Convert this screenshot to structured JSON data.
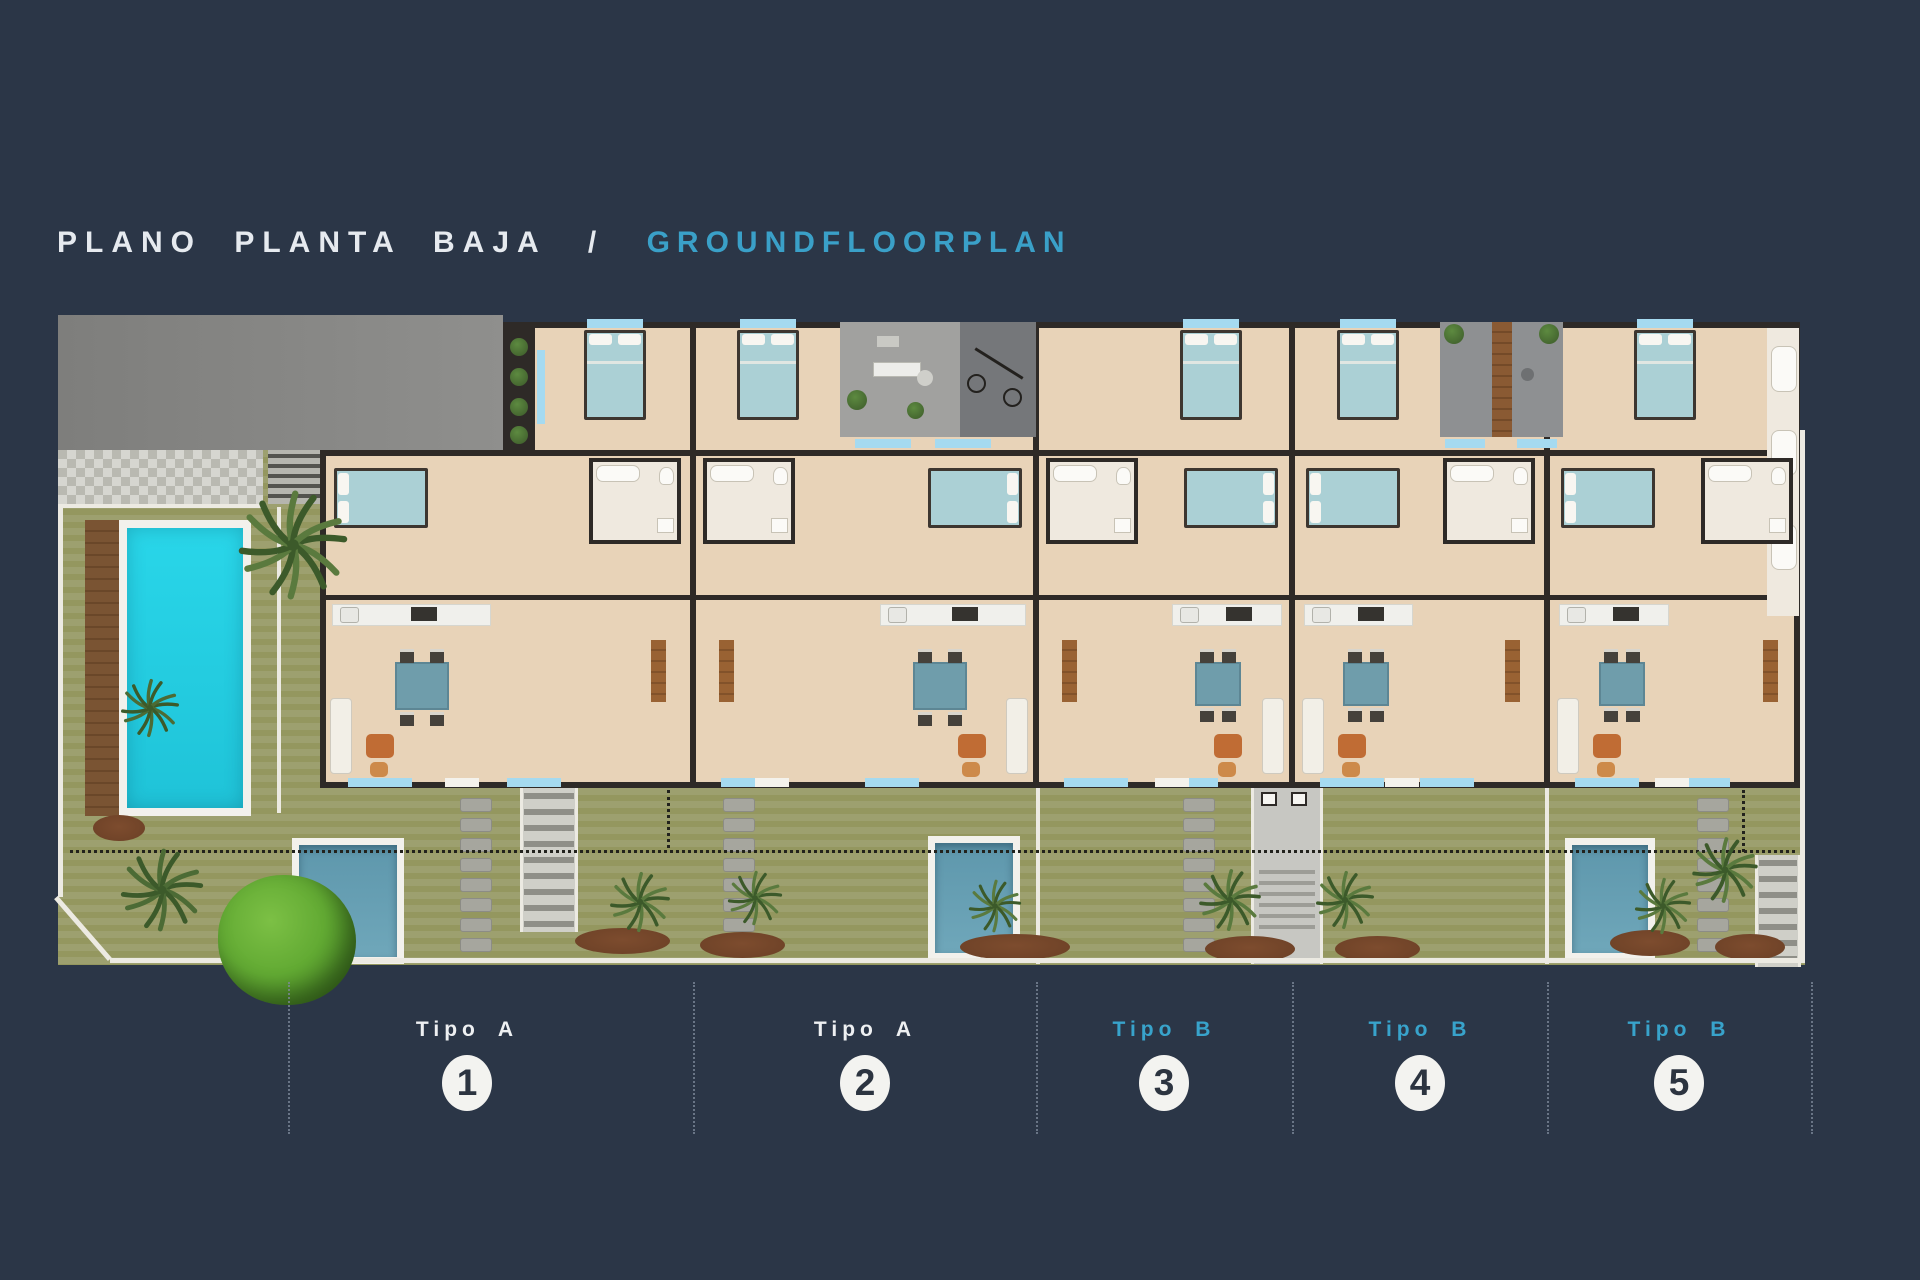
{
  "title": {
    "primary": "PLANO PLANTA BAJA",
    "separator": "/",
    "secondary": "GROUNDFLOORPLAN"
  },
  "units": [
    {
      "type": "Tipo A",
      "number": "1"
    },
    {
      "type": "Tipo A",
      "number": "2"
    },
    {
      "type": "Tipo B",
      "number": "3"
    },
    {
      "type": "Tipo B",
      "number": "4"
    },
    {
      "type": "Tipo B",
      "number": "5"
    }
  ],
  "palette": {
    "background": "#2b3647",
    "title_primary": "#e6eaef",
    "title_secondary": "#3aa0c8",
    "type_a_label": "#eef0f2",
    "type_b_label": "#38a3cb",
    "badge_bg": "#f3f3f0",
    "badge_text": "#2c3440",
    "lawn": "#9da06f",
    "lawn_stripe": "#94975f",
    "floor": "#e8d3b8",
    "wall": "#2e2a27",
    "street": "#8f8f8d",
    "paver_light": "#d6d6d0",
    "paver_dark": "#b9b9b1",
    "courtyard_light": "#a1a19f",
    "courtyard_dark": "#75777a",
    "pool_main": "#29d6e9",
    "pool_small": "#6fa7ba",
    "pool_deck": "#f2f1ec",
    "wood": "#7a5433",
    "window_blue": "#a5daf0",
    "bed_teal": "#abd0d5",
    "table_teal": "#6f9dab",
    "sofa_white": "#f2efe7",
    "armchair_orange": "#c06c34",
    "counter_white": "#f0f0ec",
    "bath_floor": "#efe9df",
    "stone_gray": "#a6a69e",
    "mulch_brown": "#6b4026",
    "palm_green": "#5a7a3e",
    "palm_dark": "#3c5a2a",
    "tree_green": "#62aa33",
    "boundary_white": "#eceae2"
  }
}
